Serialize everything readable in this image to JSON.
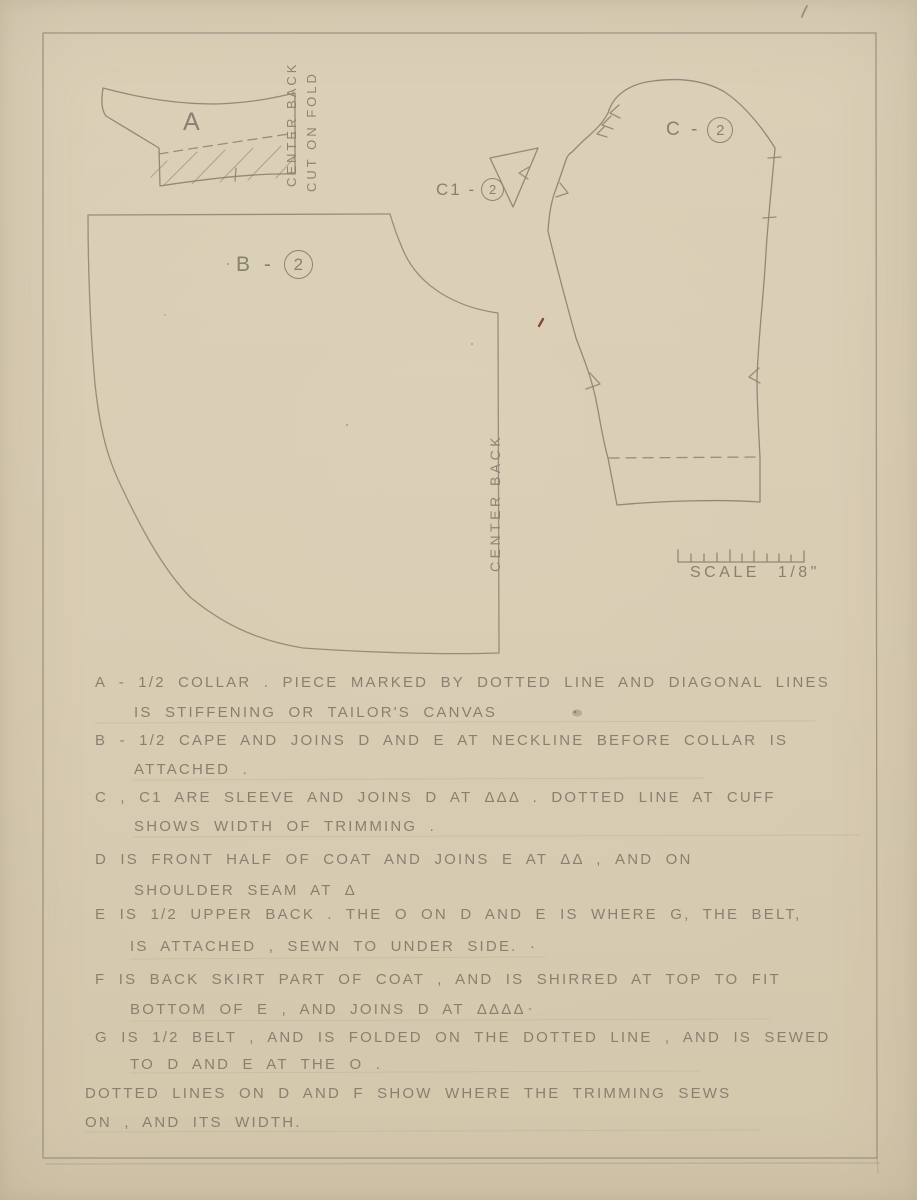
{
  "sheet": {
    "type_note": "hand-drawn sewing pattern plate, pencil on tan paper"
  },
  "pieces": {
    "a": {
      "label": "A"
    },
    "b": {
      "label_prefix": "B -",
      "label_number": "2"
    },
    "c1": {
      "label_prefix": "C1 -",
      "label_number": "2"
    },
    "c": {
      "label_prefix": "C -",
      "label_number": "2"
    }
  },
  "annotations": {
    "center_back_a": "CENTER BACK",
    "cut_on_fold": "CUT ON FOLD",
    "center_back_b": "CENTER BACK",
    "scale_label": "SCALE 1/8\""
  },
  "notes": {
    "lines": [
      "A - 1/2 COLLAR .  PIECE MARKED BY DOTTED LINE AND DIAGONAL LINES",
      "IS STIFFENING OR TAILOR'S CANVAS",
      "B - 1/2 CAPE AND JOINS D AND E AT NECKLINE BEFORE COLLAR IS",
      "ATTACHED .",
      "C , C1 ARE SLEEVE AND JOINS D AT ΔΔΔ . DOTTED LINE AT CUFF",
      "SHOWS WIDTH OF TRIMMING .",
      "D IS FRONT HALF OF COAT AND JOINS E AT ΔΔ , AND ON",
      "SHOULDER SEAM AT Δ",
      "E IS 1/2 UPPER BACK . THE O ON D AND E IS WHERE G, THE BELT,",
      "IS ATTACHED , SEWN TO UNDER SIDE. ·",
      "F IS BACK SKIRT PART OF COAT , AND IS SHIRRED AT TOP TO FIT",
      "BOTTOM OF E , AND JOINS D AT ΔΔΔΔ",
      "G IS 1/2 BELT , AND IS FOLDED ON THE DOTTED LINE , AND IS SEWED",
      "TO D AND E AT THE O .",
      "DOTTED LINES ON D AND F SHOW WHERE THE TRIMMING SEWS",
      "ON , AND ITS WIDTH."
    ]
  },
  "colors": {
    "paper": "#d8ccb2",
    "pencil": "#8b8170",
    "pencil_light": "#a79d89",
    "red_fleck": "#7b3a26"
  }
}
